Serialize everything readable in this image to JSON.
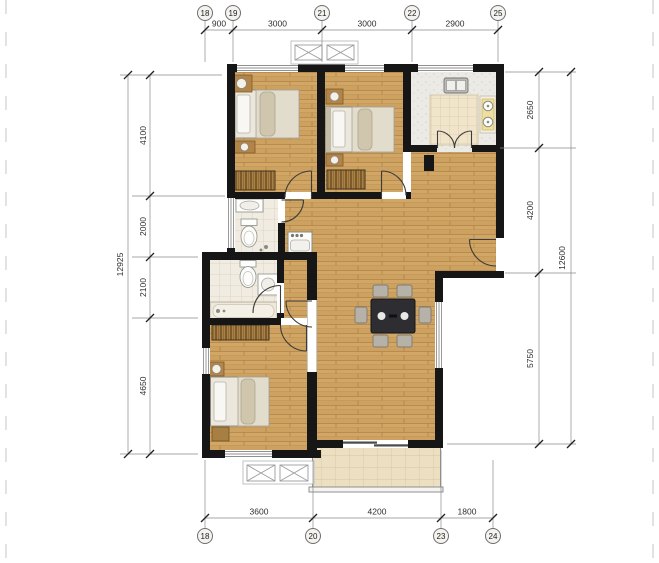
{
  "drawing": {
    "kind": "apartment floor plan"
  },
  "dims": {
    "top": {
      "grids": [
        "18",
        "19",
        "21",
        "22",
        "25"
      ],
      "segments": [
        "900",
        "3000",
        "3000",
        "2900"
      ]
    },
    "bottom": {
      "grids": [
        "18",
        "20",
        "23",
        "24"
      ],
      "segments": [
        "3600",
        "4200",
        "1800"
      ]
    },
    "left": {
      "total": "12925",
      "segments": [
        "4100",
        "2000",
        "2100",
        "4650"
      ]
    },
    "right": {
      "total": "12600",
      "segments": [
        "2650",
        "4200",
        "5750"
      ]
    }
  },
  "colors": {
    "wall": "#161616",
    "wood_floor": "#cda15f",
    "bath_tile": "#f1ece1",
    "balcony_tile": "#ecdfc2",
    "wardrobe_hatch": "#aa8145",
    "dining_table": "#2d2d32",
    "dimension_line": "#8a8a8a"
  }
}
